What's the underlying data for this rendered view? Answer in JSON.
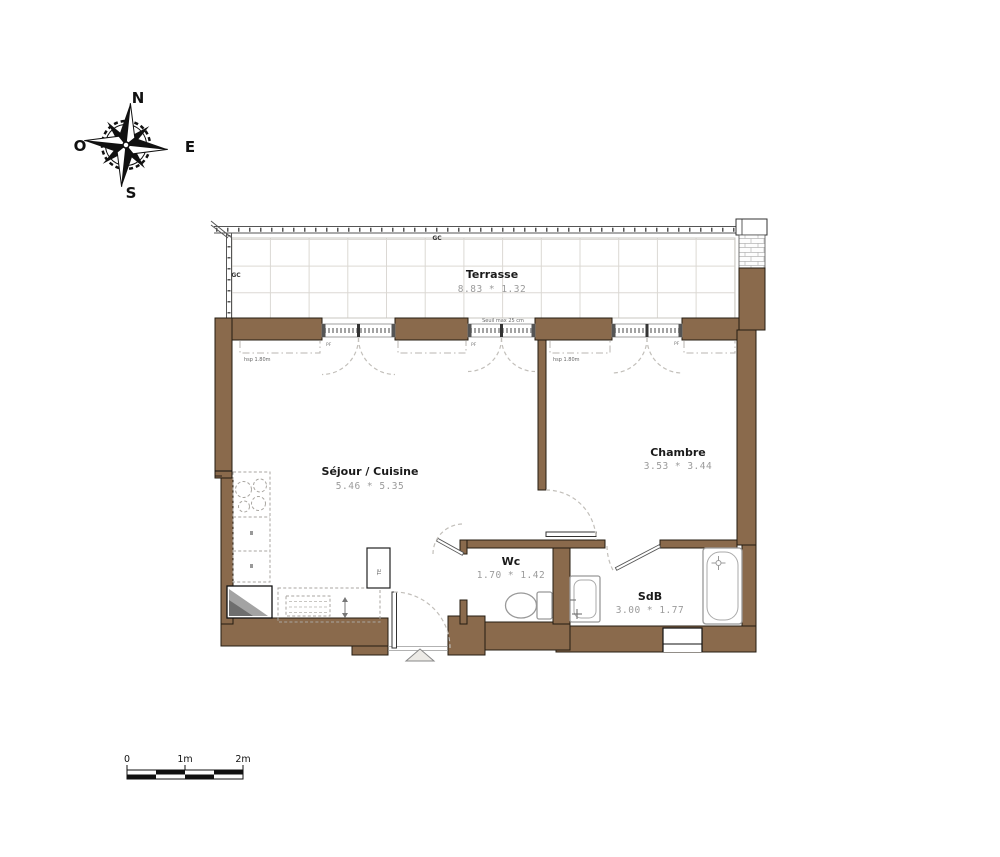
{
  "plan": {
    "compass": {
      "north": "N",
      "east": "E",
      "south": "S",
      "west": "O"
    },
    "terrace": {
      "name": "Terrasse",
      "dimensions": "8.83 * 1.32",
      "railing_label_top": "GC",
      "railing_label_left": "GC",
      "threshold_note": "Seuil max 25 cm"
    },
    "rooms": {
      "living": {
        "name": "Séjour / Cuisine",
        "dimensions": "5.46 * 5.35",
        "ceiling_height_note": "hsp 1.80m",
        "window_label": "PF"
      },
      "bedroom": {
        "name": "Chambre",
        "dimensions": "3.53 * 3.44",
        "ceiling_height_note": "hsp 1.80m",
        "window_label": "PF"
      },
      "wc": {
        "name": "Wc",
        "dimensions": "1.70 * 1.42"
      },
      "bathroom": {
        "name": "SdB",
        "dimensions": "3.00 * 1.77"
      }
    },
    "closet_label": "TE",
    "scale_bar": {
      "zero": "0",
      "one": "1m",
      "two": "2m"
    },
    "colors": {
      "wall": "#8a6a4c",
      "tile_line": "#dbd8d3",
      "arc_dash": "#c2bfba",
      "dim_text": "#9b9b9b",
      "room_text": "#1a1a1a",
      "fixture": "#999999"
    }
  }
}
